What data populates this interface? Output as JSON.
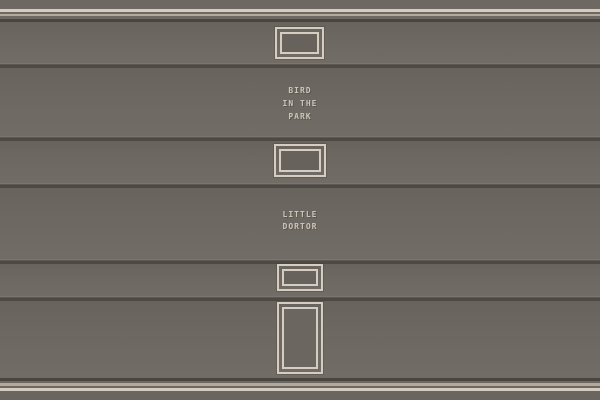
{
  "scene": {
    "kind": "game-wall-scene",
    "signs": [
      {
        "id": "bird-in-the-park",
        "lines": [
          "BIRD",
          "IN THE",
          "PARK"
        ]
      },
      {
        "id": "little-dortor",
        "lines": [
          "LITTLE",
          "DORTOR"
        ]
      }
    ]
  },
  "colors": {
    "wall": "#6E6862",
    "wall_dark": "#69635D",
    "wall_light": "#726C66",
    "joint_shadow": "#4F4944",
    "joint_highlight": "#7B756F",
    "cornice_dark": "#4A443F",
    "trim_bright": "#D3CBBF",
    "trim_dim": "#B2A99C",
    "frame": "#D5CDC1",
    "frame_interior": "#68625D",
    "door_interior": "#6C6660",
    "sign_text": "#CCC4B7",
    "floor": "#6B6560"
  }
}
